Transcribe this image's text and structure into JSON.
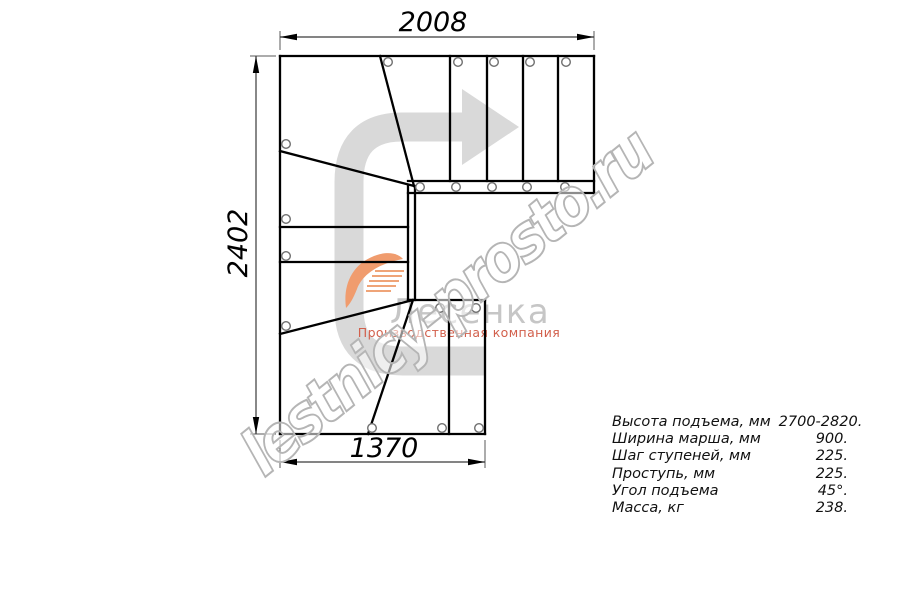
{
  "dimensions": {
    "top": "2008",
    "left": "2402",
    "bottom": "1370"
  },
  "watermark": {
    "text": "lestnicy-prosto.ru"
  },
  "logo": {
    "name": "Лесенка",
    "tagline": "Производственная компания"
  },
  "specs": [
    {
      "label": "Высота подъема, мм",
      "value": "2700-2820."
    },
    {
      "label": "Ширина марша, мм",
      "value": "900."
    },
    {
      "label": "Шаг ступеней, мм",
      "value": "225."
    },
    {
      "label": "Проступь, мм",
      "value": "225."
    },
    {
      "label": "Угол подъема",
      "value": "45°."
    },
    {
      "label": "Масса, кг",
      "value": "238."
    }
  ],
  "colors": {
    "direction_arrow": "#d9d9d9",
    "logo_swoosh": "#f09c6e",
    "logo_name": "#c6c6c6",
    "logo_tagline": "#d2604c",
    "watermark": "#b5b5b5",
    "lines": "#000000"
  }
}
